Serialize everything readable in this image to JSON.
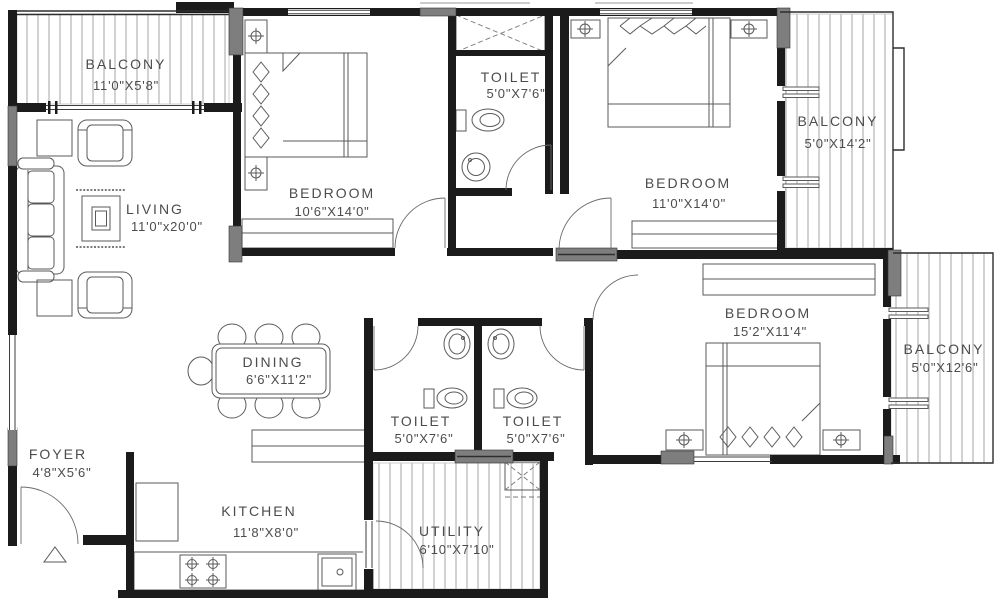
{
  "plan": {
    "title": "apartment-floor-plan",
    "rooms": [
      {
        "id": "balcony-top-left",
        "name": "BALCONY",
        "dims": "11'0\"X5'8\""
      },
      {
        "id": "bedroom-1",
        "name": "BEDROOM",
        "dims": "10'6\"X14'0\""
      },
      {
        "id": "toilet-top",
        "name": "TOILET",
        "dims": "5'0\"X7'6\""
      },
      {
        "id": "bedroom-2",
        "name": "BEDROOM",
        "dims": "11'0\"X14'0\""
      },
      {
        "id": "balcony-right-upper",
        "name": "BALCONY",
        "dims": "5'0\"X14'2\""
      },
      {
        "id": "living",
        "name": "LIVING",
        "dims": "11'0\"x20'0\""
      },
      {
        "id": "dining",
        "name": "DINING",
        "dims": "6'6\"X11'2\""
      },
      {
        "id": "toilet-center-left",
        "name": "TOILET",
        "dims": "5'0\"X7'6\""
      },
      {
        "id": "toilet-center-right",
        "name": "TOILET",
        "dims": "5'0\"X7'6\""
      },
      {
        "id": "bedroom-3",
        "name": "BEDROOM",
        "dims": "15'2\"X11'4\""
      },
      {
        "id": "balcony-right-lower",
        "name": "BALCONY",
        "dims": "5'0\"X12'6\""
      },
      {
        "id": "foyer",
        "name": "FOYER",
        "dims": "4'8\"X5'6\""
      },
      {
        "id": "kitchen",
        "name": "KITCHEN",
        "dims": "11'8\"X8'0\""
      },
      {
        "id": "utility",
        "name": "UTILITY",
        "dims": "6'10\"X7'10\""
      }
    ],
    "colors": {
      "wall": "#1b1b1b",
      "column_fill": "#7e7e7e",
      "furniture_line": "#5a5a5a",
      "hatch": "#a6a6a6",
      "label_text": "#4c4c4c",
      "window": "#3c3c3c",
      "background": "#ffffff"
    }
  }
}
